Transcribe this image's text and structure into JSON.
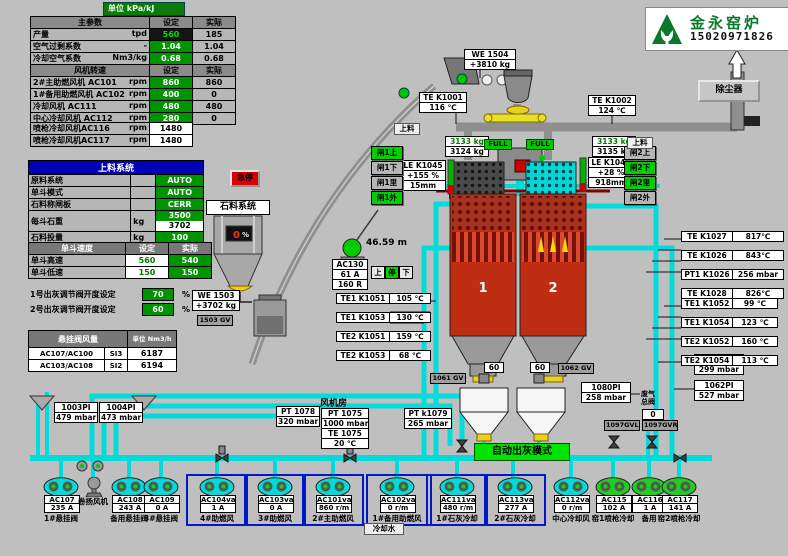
{
  "banner": {
    "unit_label": "单位 kPa/kJ"
  },
  "logo": {
    "title": "金永窑炉",
    "phone": "15020971826"
  },
  "main_table": {
    "title": "主参数",
    "col_set": "设定",
    "col_actual": "实际",
    "rows": [
      {
        "label": "产量",
        "unit": "tpd",
        "set": "560",
        "actual": "185",
        "style": "dark"
      },
      {
        "label": "空气过剩系数",
        "unit": "-",
        "set": "1.04",
        "actual": "1.04",
        "style": "green"
      },
      {
        "label": "冷却空气系数",
        "unit": "Nm3/kg",
        "set": "0.68",
        "actual": "0.68",
        "style": "green"
      }
    ],
    "fan_title": "风机转速",
    "fan_col_set": "设定",
    "fan_col_actual": "实际",
    "fan_rows": [
      {
        "label": "2#主助燃风机 AC101",
        "unit": "rpm",
        "set": "860",
        "actual": "860"
      },
      {
        "label": "1#备用助燃风机 AC102",
        "unit": "rpm",
        "set": "400",
        "actual": "0"
      },
      {
        "label": "冷却风机 AC111",
        "unit": "rpm",
        "set": "480",
        "actual": "480"
      },
      {
        "label": "中心冷却风机 AC112",
        "unit": "rpm",
        "set": "280",
        "actual": "0"
      }
    ],
    "gun_rows": [
      {
        "label": "喷枪冷却风机AC116",
        "unit": "rpm",
        "value": "1480"
      },
      {
        "label": "喷枪冷却风机AC117",
        "unit": "rpm",
        "value": "1480"
      }
    ]
  },
  "feed_table": {
    "title": "上料系统",
    "rows": [
      {
        "label": "原料系统",
        "unit": "",
        "value": "AUTO"
      },
      {
        "label": "单斗模式",
        "unit": "",
        "value": "AUTO"
      },
      {
        "label": "石料称闸板",
        "unit": "",
        "value": "CERR"
      },
      {
        "label": "每斗石重",
        "unit": "kg",
        "value": "3500",
        "value2": "3702"
      },
      {
        "label": "石料投量",
        "unit": "kg",
        "value": "100"
      }
    ]
  },
  "speed_table": {
    "title": "单斗速度",
    "col_set": "设定",
    "col_actual": "实际",
    "rows": [
      {
        "label": "单斗高速",
        "set": "560",
        "actual": "540"
      },
      {
        "label": "单斗低速",
        "set": "150",
        "actual": "150"
      }
    ]
  },
  "valve_settings": [
    {
      "label": "1号出灰调节阀开度设定",
      "value": "70",
      "unit": "%"
    },
    {
      "label": "2号出灰调节阀开度设定",
      "value": "60",
      "unit": "%"
    }
  ],
  "flow_table": {
    "title": "悬挂阀风量",
    "unit_header": "单位 Nm3/h",
    "rows": [
      {
        "label": "AC107/AC100",
        "tag": "SI3",
        "value": "6187"
      },
      {
        "label": "AC103/AC108",
        "tag": "SI2",
        "value": "6194"
      }
    ]
  },
  "instruments": [
    {
      "id": "we1504",
      "lines": [
        "WE 1504",
        "+3810  kg"
      ]
    },
    {
      "id": "te_k1001",
      "lines": [
        "TE K1001",
        "116 ℃"
      ]
    },
    {
      "id": "te_k1002",
      "lines": [
        "TE K1002",
        "124 ℃"
      ]
    },
    {
      "id": "weight_left",
      "lines": [
        "3133 kg",
        "3124 kg"
      ]
    },
    {
      "id": "weight_right",
      "lines": [
        "3133 kg",
        "3135 kg"
      ]
    },
    {
      "id": "le_k1045",
      "lines": [
        "LE K1045",
        "+155  %",
        "15mm"
      ]
    },
    {
      "id": "le_k1046",
      "lines": [
        "LE K1046",
        "+28  %",
        "918mm"
      ]
    },
    {
      "id": "we1503",
      "lines": [
        "WE 1503",
        "+3702  kg"
      ]
    },
    {
      "id": "gv1503",
      "lines": [
        "1503 GV"
      ]
    },
    {
      "id": "ac130",
      "lines": [
        "AC130",
        "61 A",
        "160 R"
      ]
    },
    {
      "id": "pi1081",
      "lines": [
        "1081PI",
        "299 mbar"
      ]
    },
    {
      "id": "pi1062",
      "lines": [
        "1062PI",
        "527 mbar"
      ]
    },
    {
      "id": "pi1080",
      "lines": [
        "1080PI",
        "258 mbar"
      ]
    },
    {
      "id": "gv1061",
      "lines": [
        "1061 GV"
      ]
    },
    {
      "id": "gv1062",
      "lines": [
        "1062 GV"
      ]
    },
    {
      "id": "gate60a",
      "lines": [
        "60"
      ]
    },
    {
      "id": "gate60b",
      "lines": [
        "60"
      ]
    },
    {
      "id": "pt1078",
      "lines": [
        "PT 1078",
        "320 mbar"
      ]
    },
    {
      "id": "fan_stack",
      "lines": [
        "PT 1075",
        "1000 mbar",
        "TE 1075",
        "20  ℃"
      ]
    },
    {
      "id": "ptk1079",
      "lines": [
        "PT k1079",
        "265 mbar"
      ]
    },
    {
      "id": "pi1003",
      "lines": [
        "1003PI",
        "479 mbar"
      ]
    },
    {
      "id": "pi1004",
      "lines": [
        "1004PI",
        "473 mbar"
      ]
    },
    {
      "id": "gvl",
      "lines": [
        "1097GVL"
      ]
    },
    {
      "id": "gvr",
      "lines": [
        "1097GVR"
      ]
    },
    {
      "id": "waste_pos",
      "lines": [
        "0"
      ]
    }
  ],
  "pair_groups": [
    {
      "id": "kiln_temps_left",
      "rows": [
        [
          "TE1 K1051",
          "105 ℃"
        ],
        [
          "TE1 K1053",
          "130 ℃"
        ],
        [
          "TE2 K1051",
          "159 ℃"
        ],
        [
          "TE2 K1053",
          "68 ℃"
        ]
      ]
    },
    {
      "id": "kiln_temps_right_a",
      "rows": [
        [
          "TE K1027",
          "817℃"
        ],
        [
          "TE K1026",
          "843℃"
        ],
        [
          "PT1 K1026",
          "256 mbar"
        ],
        [
          "TE K1028",
          "826℃"
        ]
      ]
    },
    {
      "id": "kiln_temps_right_b",
      "rows": [
        [
          "TE1 K1052",
          "99  ℃"
        ],
        [
          "TE1 K1054",
          "123  ℃"
        ],
        [
          "TE2 K1052",
          "160  ℃"
        ],
        [
          "TE2 K1054",
          "113  ℃"
        ]
      ]
    }
  ],
  "gates": [
    {
      "id": "gate1-up",
      "label": "闸1上",
      "on": true
    },
    {
      "id": "gate1-down",
      "label": "闸1下",
      "on": false
    },
    {
      "id": "gate1-in",
      "label": "闸1里",
      "on": false
    },
    {
      "id": "gate1-out",
      "label": "闸1外",
      "on": true
    },
    {
      "id": "gate2-up",
      "label": "闸2上",
      "on": false
    },
    {
      "id": "gate2-down",
      "label": "闸2下",
      "on": true
    },
    {
      "id": "gate2-in",
      "label": "闸2里",
      "on": true
    },
    {
      "id": "gate2-out",
      "label": "闸2外",
      "on": false
    }
  ],
  "buttons": {
    "estop": "急停",
    "dust_collector": "除尘器",
    "auto_discharge": "自动出灰模式",
    "hoist": [
      {
        "label": "上",
        "on": false
      },
      {
        "label": "停",
        "on": true
      },
      {
        "label": "下",
        "on": false
      }
    ]
  },
  "badges": [
    {
      "id": "full_left",
      "text": "FULL"
    },
    {
      "id": "full_right",
      "text": "FULL"
    },
    {
      "id": "feed_left",
      "text": "上料"
    },
    {
      "id": "feed_right",
      "text": "上料"
    },
    {
      "id": "height",
      "text": "46.59  m"
    },
    {
      "id": "fan_room",
      "text": "风机房"
    },
    {
      "id": "cooling_water",
      "text": "冷却水"
    },
    {
      "id": "stone_system",
      "text": "石料系统"
    },
    {
      "id": "waste1",
      "text": "废气"
    },
    {
      "id": "waste2",
      "text": "总阀"
    }
  ],
  "kilns": [
    {
      "number": "1"
    },
    {
      "number": "2"
    }
  ],
  "stone_bin": {
    "level": "0",
    "unit": "%"
  },
  "motors": [
    {
      "id": "ac107",
      "tag": "AC107",
      "value": "235 A",
      "label": "1#悬挂阀",
      "kind": "cyan"
    },
    {
      "id": "winch",
      "label": "卷扬风机",
      "kind": "winch"
    },
    {
      "id": "ac108",
      "tag": "AC108",
      "value": "243 A",
      "label": "备用悬挂阀",
      "kind": "cyan"
    },
    {
      "id": "ac109",
      "tag": "AC109",
      "value": "0 A",
      "label": "3#悬挂阀",
      "kind": "cyan"
    },
    {
      "id": "ac104",
      "tag": "AC104va",
      "value": "1 A",
      "label": "4#助燃风",
      "kind": "cyan",
      "framed": true
    },
    {
      "id": "ac103",
      "tag": "AC103va",
      "value": "0 A",
      "label": "3#助燃风",
      "kind": "cyan",
      "framed": true
    },
    {
      "id": "ac101",
      "tag": "AC101va",
      "value": "860 r/m",
      "label": "2#主助燃风",
      "kind": "cyan",
      "framed": true
    },
    {
      "id": "ac102",
      "tag": "AC102va",
      "value": "0 r/m",
      "label": "1#备用助燃风",
      "kind": "cyan",
      "framed": true
    },
    {
      "id": "ac111",
      "tag": "AC111va",
      "value": "480 r/m",
      "label": "1#石灰冷却",
      "kind": "cyan",
      "framed": true
    },
    {
      "id": "ac113",
      "tag": "AC113va",
      "value": "277 A",
      "label": "2#石灰冷却",
      "kind": "cyan",
      "framed": true
    },
    {
      "id": "ac112",
      "tag": "AC112va",
      "value": "0 r/m",
      "label": "中心冷却风",
      "kind": "cyan"
    },
    {
      "id": "ac115",
      "tag": "AC115",
      "value": "102 A",
      "label": "窑1喷枪冷却",
      "kind": "green"
    },
    {
      "id": "ac116",
      "tag": "AC116",
      "value": "1 A",
      "label": "备用",
      "kind": "green"
    },
    {
      "id": "ac117",
      "tag": "AC117",
      "value": "141 A",
      "label": "窑2喷枪冷却",
      "kind": "green"
    }
  ],
  "colors": {
    "pipe_cyan": "#00dcdc",
    "kiln_red": "#bf2e12",
    "on_green": "#00d000",
    "set_green": "#009400",
    "header_blue": "#0000b4",
    "alarm_red": "#d80000"
  }
}
